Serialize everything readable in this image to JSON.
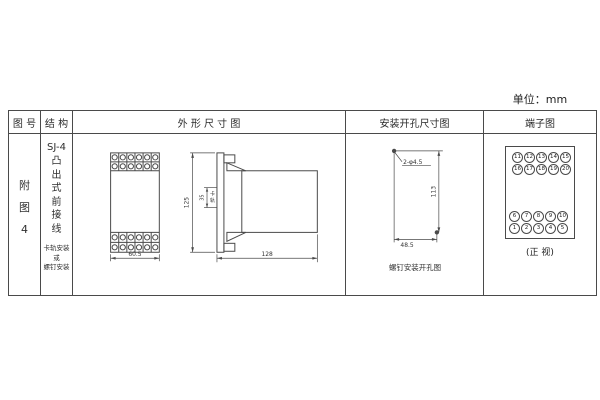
{
  "unit_label": "单位：mm",
  "table": {
    "headers": {
      "figure_no": "图 号",
      "structure": "结 构",
      "outline": "外 形 尺 寸 图",
      "install": "安装开孔尺寸图",
      "terminal": "端子图"
    }
  },
  "figure_no": {
    "chars": [
      "附",
      "图",
      "4"
    ]
  },
  "structure": {
    "model": "SJ-4",
    "type_chars": [
      "凸",
      "出",
      "式",
      "前",
      "接",
      "线"
    ],
    "mount_lines": [
      "卡轨安装",
      "或",
      "螺钉安装"
    ]
  },
  "outline": {
    "front": {
      "width_dim": "60.5"
    },
    "side": {
      "height_dim": "125",
      "rail_dim": "35",
      "rail_label_chars": [
        "卡",
        "轨"
      ],
      "depth_dim": "128"
    }
  },
  "install": {
    "holes_label": "2-φ4.5",
    "vertical_dim": "113",
    "horizontal_dim": "48.5",
    "caption": "螺钉安装开孔图"
  },
  "terminal": {
    "caption": "(正 视)",
    "top_rows": [
      [
        "11",
        "12",
        "13",
        "14",
        "15"
      ],
      [
        "16",
        "17",
        "18",
        "19",
        "20"
      ]
    ],
    "bottom_rows": [
      [
        "6",
        "7",
        "8",
        "9",
        "10"
      ],
      [
        "1",
        "2",
        "3",
        "4",
        "5"
      ]
    ]
  }
}
